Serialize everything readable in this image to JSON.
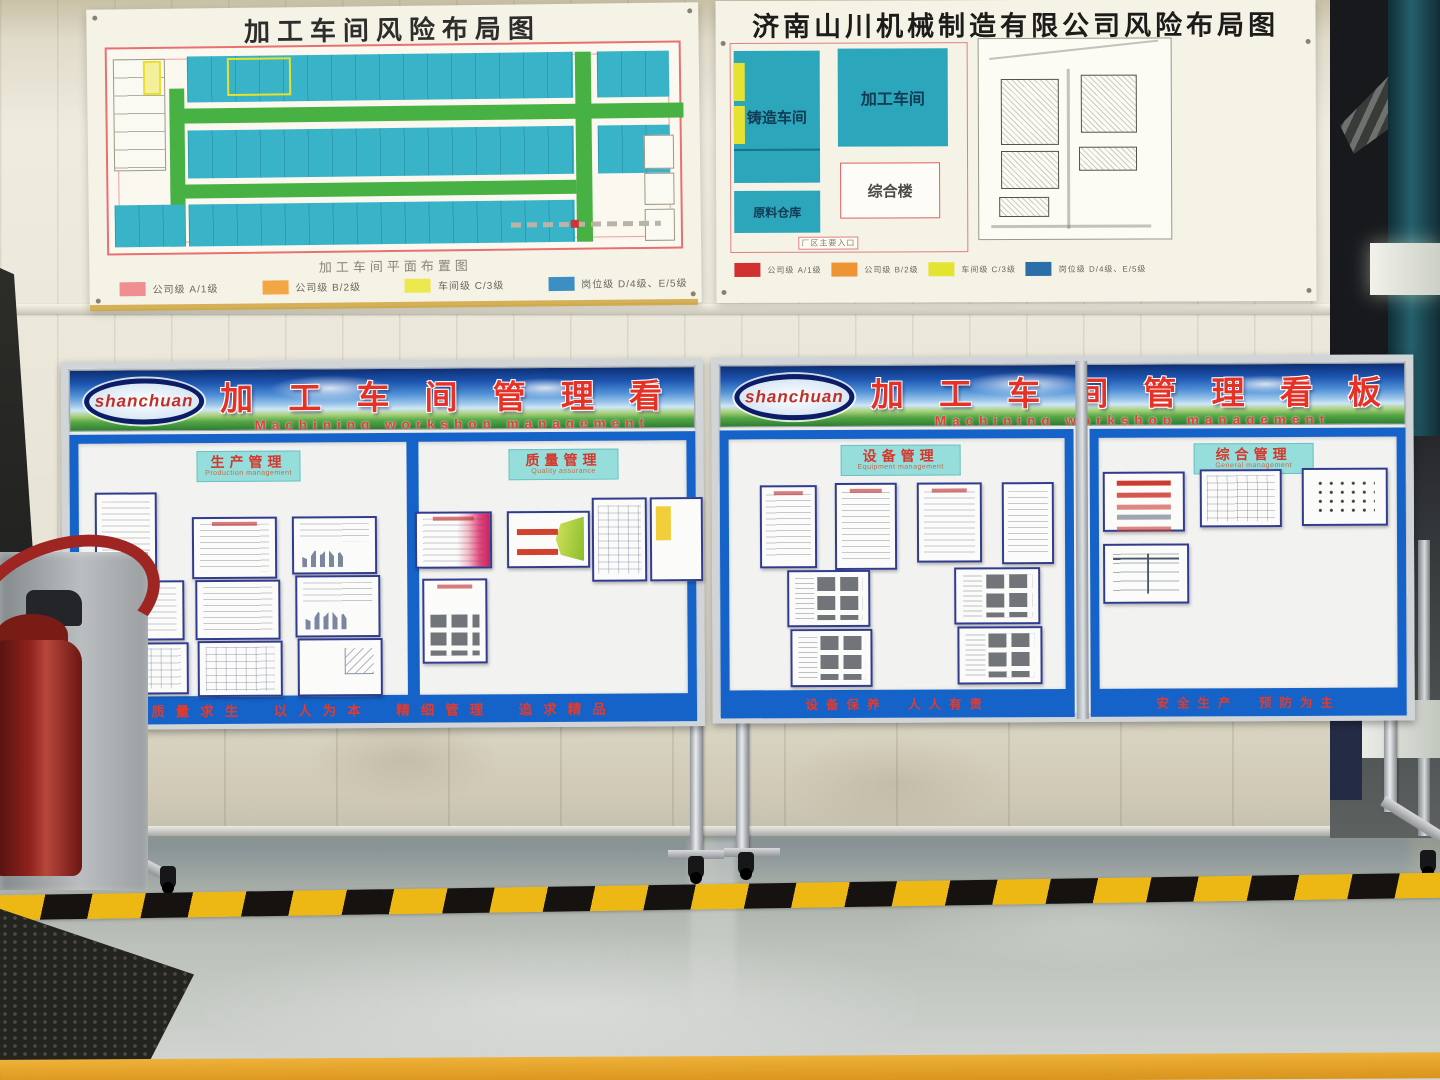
{
  "scene": {
    "accent_blue": "#1563c8",
    "hazard_yellow": "#edb714",
    "wall_color": "#e7e3d6",
    "floor_color": "#b9bfb9"
  },
  "posters": {
    "left": {
      "title": "加工车间风险布局图",
      "caption": "加工车间平面布置图",
      "legend": [
        {
          "label": "公司级  A/1级",
          "swatch": "background:#ef8f8f"
        },
        {
          "label": "公司级  B/2级",
          "swatch": "background:#f2a644"
        },
        {
          "label": "车间级  C/3级",
          "swatch": "background:#ece94e"
        },
        {
          "label": "岗位级  D/4级、E/5级",
          "swatch": "background:#3c8fc4"
        }
      ]
    },
    "right": {
      "title": "济南山川机械制造有限公司风险布局图",
      "blocks": {
        "casting": "铸造车间",
        "machining": "加工车间",
        "complex": "综合楼",
        "warehouse": "原料仓库",
        "entrance": "厂区主要入口"
      },
      "legend": [
        {
          "label": "公司级 A/1级",
          "swatch": "background:#d03030"
        },
        {
          "label": "公司级 B/2级",
          "swatch": "background:#ef9434"
        },
        {
          "label": "车间级 C/3级",
          "swatch": "background:#e3e432"
        },
        {
          "label": "岗位级 D/4级、E/5级",
          "swatch": "background:#2b6fa8"
        }
      ]
    }
  },
  "boards": {
    "left": {
      "logo": "shanchuan",
      "title_cn": "加 工 车 间 管 理 看 板",
      "title_en": "Machining workshop management",
      "sections": [
        {
          "name": "生产管理",
          "en": "Production management"
        },
        {
          "name": "质量管理",
          "en": "Quality assurance"
        }
      ],
      "slogan": "质量求生　以人为本　精细管理　追求精品"
    },
    "right": {
      "logo": "shanchuan",
      "title_cn": "加 工 车 间 管 理 看 板",
      "title_en": "Machining workshop management",
      "sections": [
        {
          "name": "设备管理",
          "en": "Equipment management"
        },
        {
          "name": "综合管理",
          "en": "General management"
        }
      ],
      "slogan1": "设备保养　人人有责",
      "slogan2": "安全生产　预防为主"
    }
  }
}
